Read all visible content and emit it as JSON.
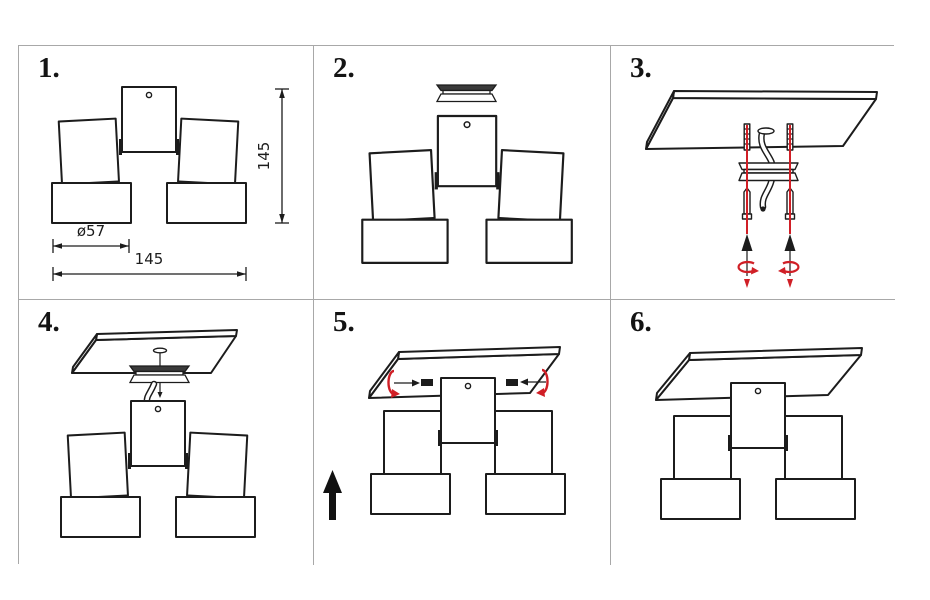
{
  "colors": {
    "background": "#ffffff",
    "line": "#1c1c1c",
    "accent_red": "#d01f26",
    "grid_border": "#a8a8a8"
  },
  "panels": [
    {
      "label": "1.",
      "dims": {
        "diameter": "ø57",
        "width": "145",
        "height": "145"
      }
    },
    {
      "label": "2."
    },
    {
      "label": "3."
    },
    {
      "label": "4."
    },
    {
      "label": "5."
    },
    {
      "label": "6."
    }
  ]
}
